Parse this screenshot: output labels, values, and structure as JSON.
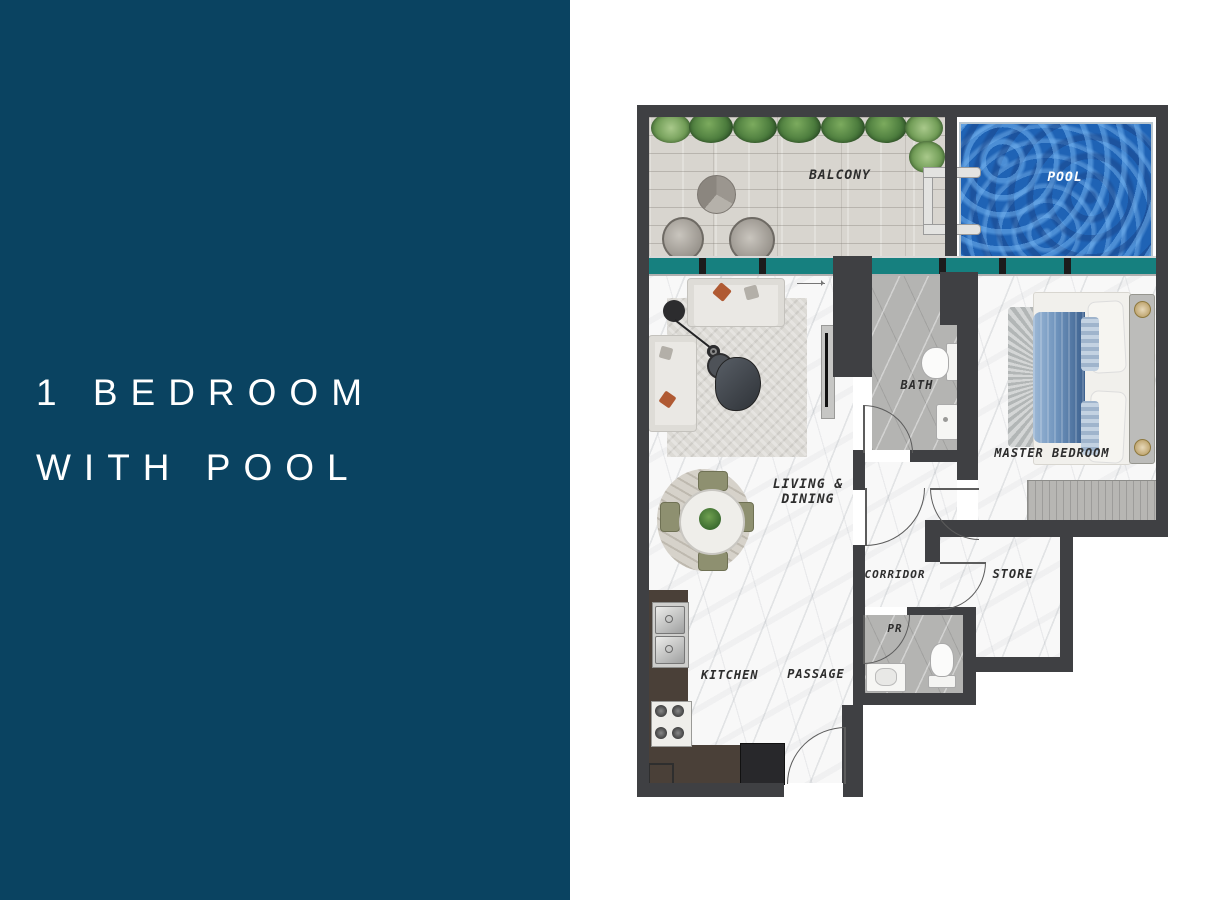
{
  "panel": {
    "bg_color": "#0a4361",
    "title_line1": "1 BEDROOM",
    "title_line2": "WITH POOL"
  },
  "floorplan": {
    "labels": {
      "balcony": "BALCONY",
      "pool": "POOL",
      "living_dining_line1": "LIVING &",
      "living_dining_line2": "DINING",
      "bath": "BATH",
      "master_bedroom": "MASTER BEDROOM",
      "corridor": "CORRIDOR",
      "store": "STORE",
      "pr": "PR",
      "kitchen": "KITCHEN",
      "passage": "PASSAGE"
    },
    "colors": {
      "wall_color": "#3f4043",
      "window_teal": "#16807f",
      "pool_water": "#1f63b5",
      "balcony_wood": "#d8d5cf",
      "marble_floor": "#f8f8f8",
      "gray_floor": "#b4b4b2",
      "kitchen_counter": "#4a4038",
      "label_color": "#2d2d2d"
    }
  }
}
